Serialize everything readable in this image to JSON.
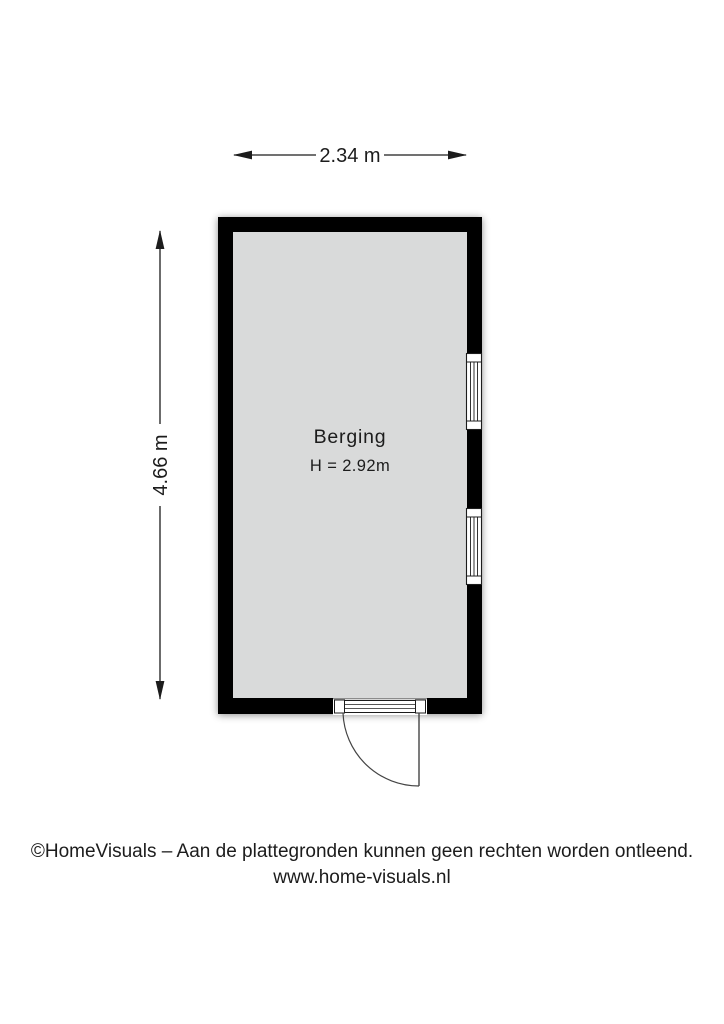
{
  "floor_plan": {
    "room": {
      "name": "Berging",
      "ceiling_height_label": "H = 2.92m"
    },
    "dimensions": {
      "width_label": "2.34 m",
      "height_label": "4.66 m"
    },
    "features": {
      "windows_right_wall": 2,
      "doors_bottom_wall": 1
    },
    "colors": {
      "wall": "#000000",
      "floor": "#d9dada",
      "background": "#ffffff",
      "line": "#1c1c1c",
      "door_line": "#444444"
    }
  },
  "footer": {
    "copyright": "©HomeVisuals – Aan de plattegronden kunnen geen rechten worden ontleend.",
    "website": "www.home-visuals.nl"
  }
}
